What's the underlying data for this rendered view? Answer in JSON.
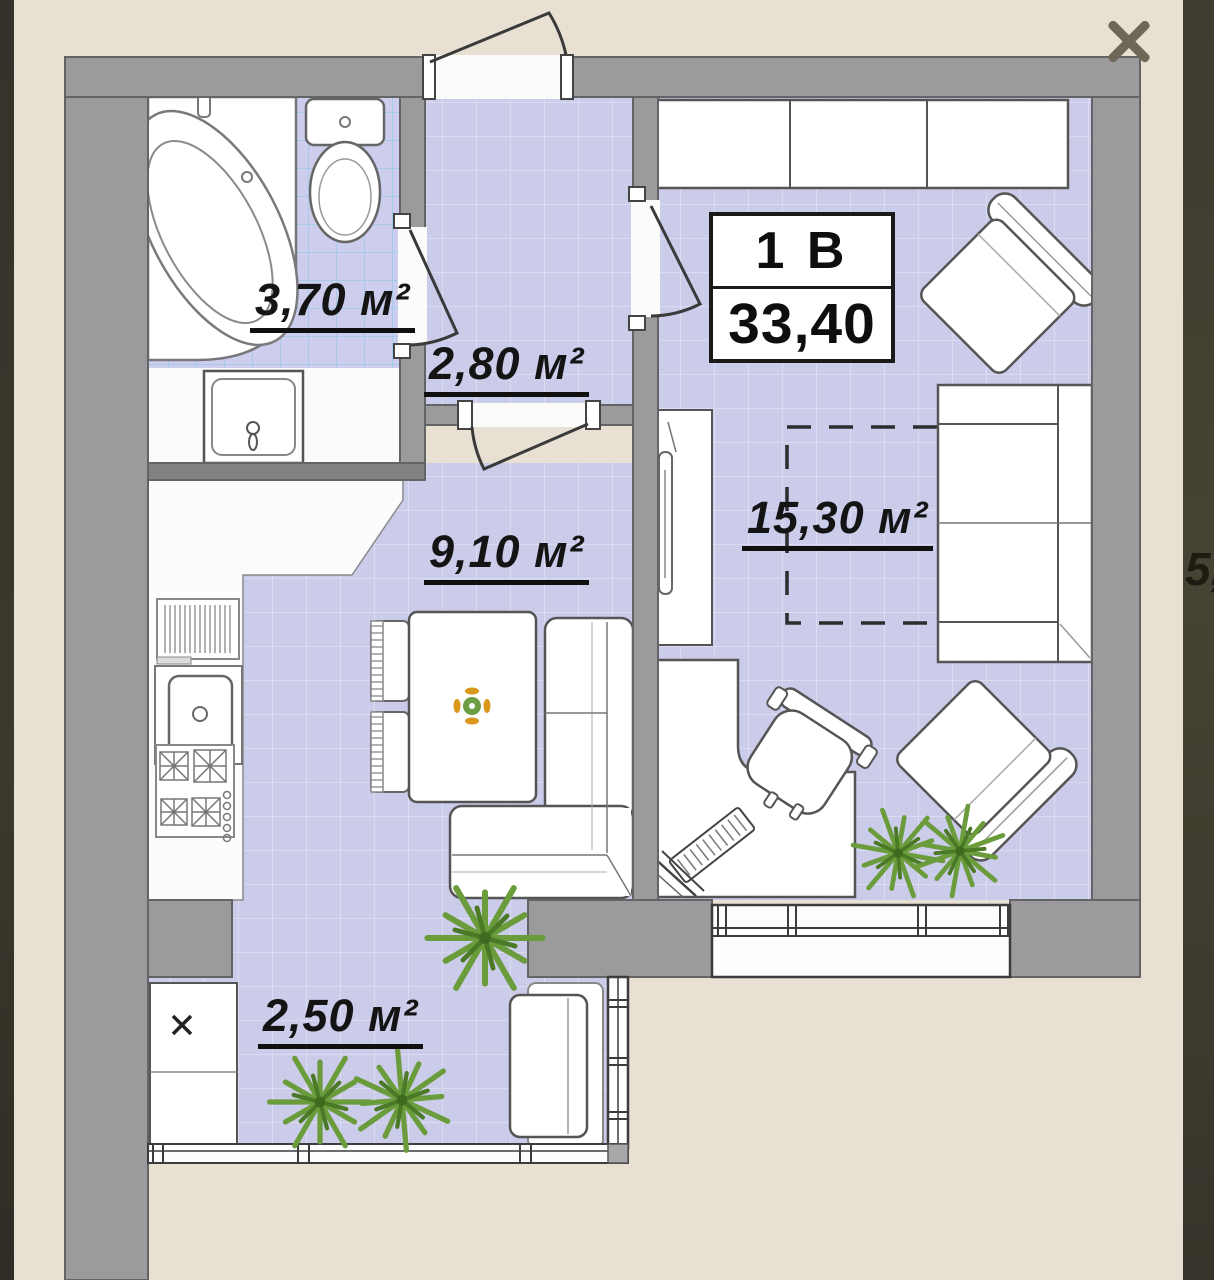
{
  "lightbox": {
    "close_icon": "x-close"
  },
  "floor_plan": {
    "unit_box": {
      "unit": "1 B",
      "area": "33,40"
    },
    "rooms": [
      {
        "name": "bathroom",
        "area_label": "3,70 м²"
      },
      {
        "name": "hallway",
        "area_label": "2,80 м²"
      },
      {
        "name": "kitchen",
        "area_label": "9,10 м²"
      },
      {
        "name": "living-room",
        "area_label": "15,30 м²"
      },
      {
        "name": "balcony",
        "area_label": "2,50 м²"
      }
    ],
    "edge_text_fragment": "5,"
  },
  "colors": {
    "background": "#e8e0d2",
    "wall": "#9b9a9c",
    "floor": "#cbcbea",
    "tile_grid_blue": "#a6cbe9",
    "side_strip": "#3c392e",
    "close_icon": "#6d6659"
  }
}
